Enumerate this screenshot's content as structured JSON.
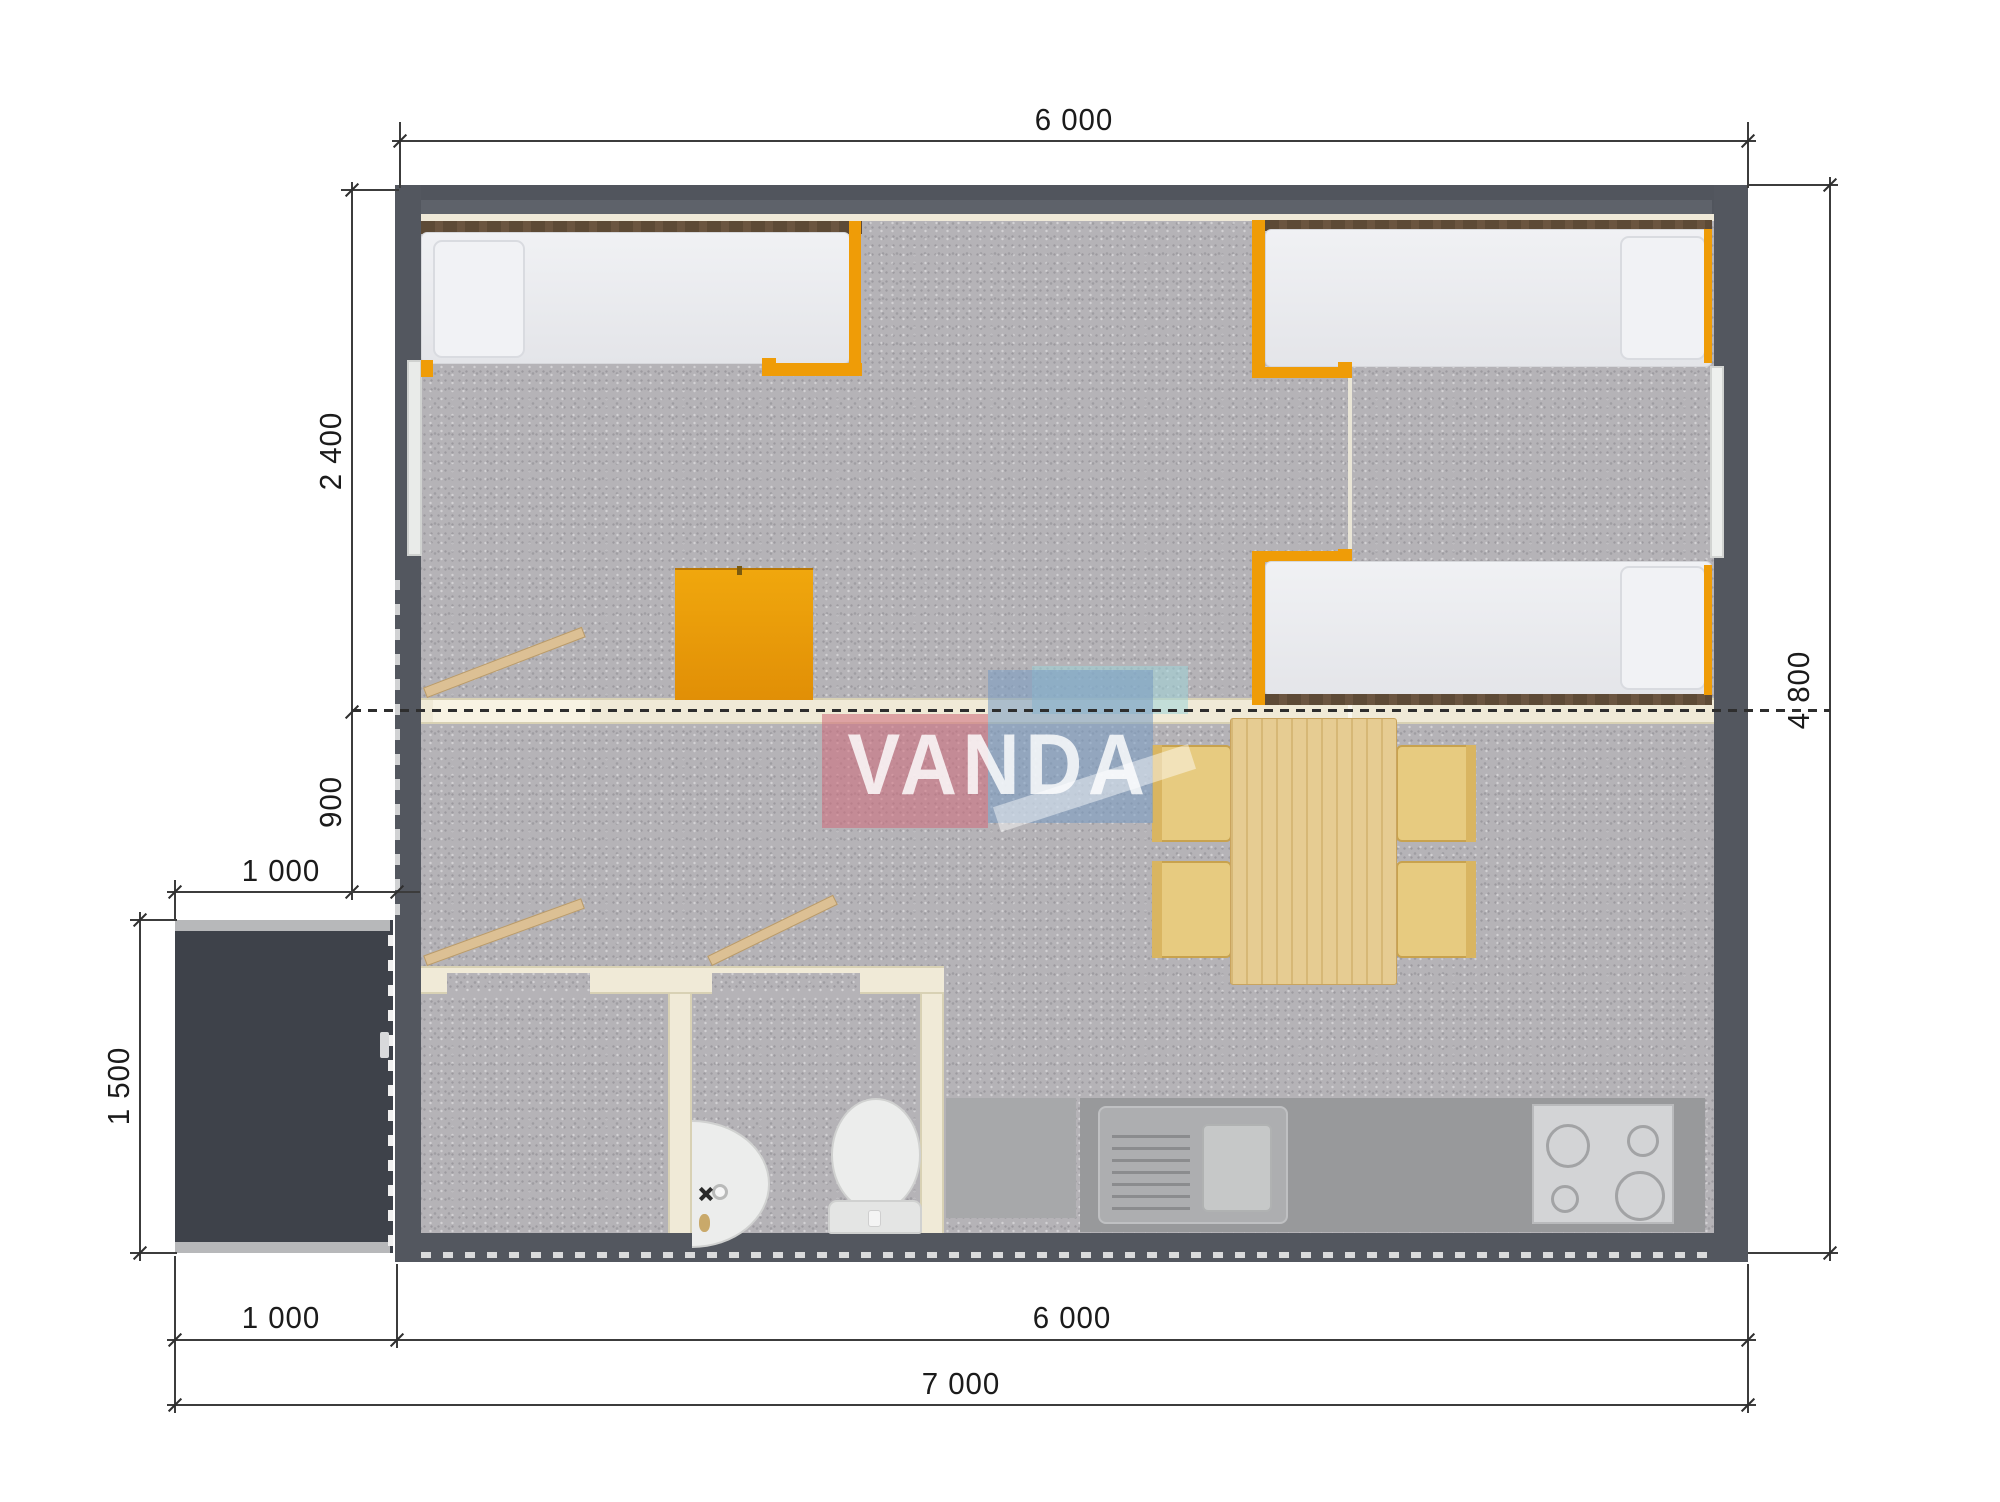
{
  "watermark": {
    "brand": "VANDA"
  },
  "dimensions": {
    "top_width": "6 000",
    "bedroom_depth": "2 400",
    "hall_depth": "900",
    "porch_width_top": "1 000",
    "porch_depth": "1 500",
    "porch_width_bottom": "1 000",
    "main_width_bottom": "6 000",
    "total_width": "7 000",
    "total_depth": "4 800"
  },
  "colors": {
    "wall": "#53575f",
    "porch": "#3e424a",
    "carpet": "#b5b3b7",
    "partition": "#f0ead7",
    "furniture_accent": "#ef9c07",
    "wood": "#e6cc92",
    "counter": "#98999b",
    "watermark_pink": "#cf6f7d",
    "watermark_blue": "#7b9cc2",
    "watermark_cyan": "#9fd3d8"
  }
}
